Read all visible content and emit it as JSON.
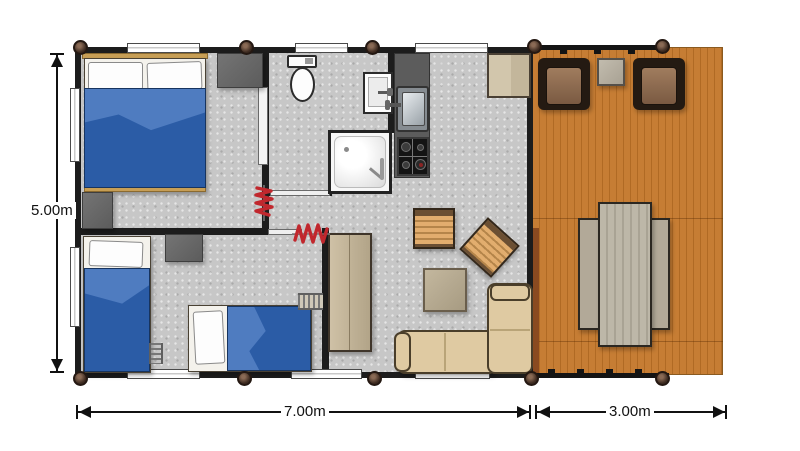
{
  "diagram": {
    "type": "floor-plan",
    "subject": "mobile-home chalet plan with terrace"
  },
  "dimensions": {
    "height_label": "5.00m",
    "width_label": "7.00m",
    "terrace_width_label": "3.00m"
  },
  "rooms": [
    {
      "name": "double-bedroom"
    },
    {
      "name": "twin-bedroom"
    },
    {
      "name": "bathroom"
    },
    {
      "name": "kitchen"
    },
    {
      "name": "living-room"
    },
    {
      "name": "terrace-deck"
    }
  ],
  "furniture_icons": [
    "double-bed-icon",
    "wardrobe-icon",
    "dresser-icon",
    "single-bed-icon",
    "single-bed-icon",
    "ladder-icon",
    "ladder-icon",
    "toilet-icon",
    "washbasin-icon",
    "shower-icon",
    "kitchen-sink-icon",
    "gas-hob-icon",
    "fridge-cabinet-icon",
    "tall-cabinet-icon",
    "slatted-chair-icon",
    "slatted-chair-icon",
    "coffee-table-icon",
    "corner-sofa-icon",
    "deck-armchair-icon",
    "deck-armchair-icon",
    "deck-side-table-icon",
    "picnic-table-icon",
    "picnic-bench-icon",
    "picnic-bench-icon",
    "door-spring-icon",
    "door-spring-icon",
    "corner-post-icon"
  ],
  "colors": {
    "wall": "#1c1c1c",
    "floor_gray": "#c7c7c7",
    "deck_orange": "#c67d34",
    "deck_plank_line": "#b06a24",
    "duvet_blue": "#2b5ca6",
    "duvet_fold_blue": "#4f7cc0",
    "headboard_tan": "#c79e55",
    "dark_cabinet_gray": "#666666",
    "tan_cabinet": "#c9baa0",
    "sofa_cream": "#dfcaa2",
    "armchair_brown": "#8a6a50",
    "armchair_frame": "#241a12",
    "outdoor_table_gray": "#b5ae9e",
    "kitchen_counter": "#5c5c5c",
    "hob_black": "#141414",
    "spring_red": "#c1272d",
    "dimension_text": "#111111"
  }
}
